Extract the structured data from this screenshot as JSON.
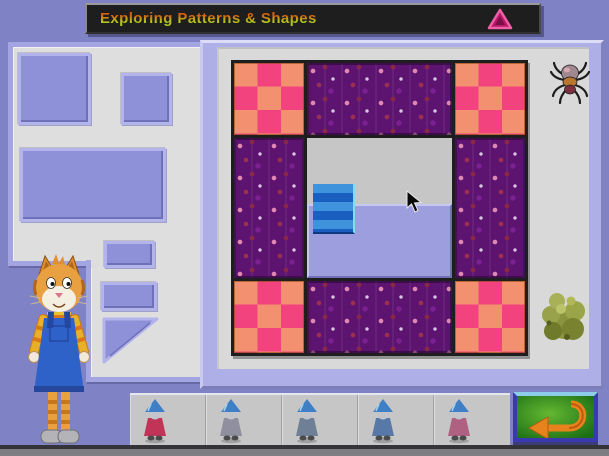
{
  "window": {
    "title": "Exploring Patterns & Shapes"
  },
  "titlebar": {
    "bg_color": "#1e1e1e",
    "title_color_top": "#d4620f",
    "title_color_bottom": "#b4c61a",
    "triangle_icon": "pink-triangle",
    "triangle_fill": "#b81868",
    "triangle_stroke": "#f060a8"
  },
  "palette": {
    "background": "#8082c6",
    "tray_bg": "#dededf",
    "tray_border": "#a3a5e2",
    "shape_fill": "#8f91d8",
    "mat_frame": "#aeafe6",
    "mat_bg": "#d9d9d9",
    "checker_salmon": "#f2906f",
    "checker_pink": "#f2437f",
    "floral_purple": "#5d1470",
    "workspace_gray": "#c6c6c6",
    "piece_blue_dark": "#1a5fc0",
    "piece_blue_light": "#3e93dc",
    "piece_lavender": "#9c9ede",
    "strip_bg": "#c6c6c6",
    "button_green": "#2f9a28",
    "button_border_blue": "#3a3aae",
    "button_arrow_orange": "#e8821c"
  },
  "tray": {
    "shapes": [
      {
        "name": "square-large",
        "type": "square"
      },
      {
        "name": "square-small",
        "type": "square"
      },
      {
        "name": "rectangle-large",
        "type": "rectangle"
      },
      {
        "name": "rectangle-small-top",
        "type": "rectangle"
      },
      {
        "name": "rectangle-small-bottom",
        "type": "rectangle"
      },
      {
        "name": "right-triangle",
        "type": "triangle"
      }
    ]
  },
  "quilt": {
    "rows": 3,
    "cols": 3,
    "cells": [
      [
        "checkered",
        "floral",
        "checkered"
      ],
      [
        "floral",
        "workspace",
        "floral"
      ],
      [
        "checkered",
        "floral",
        "checkered"
      ]
    ],
    "workspace_pieces": [
      {
        "name": "blue-striped-square"
      },
      {
        "name": "lavender-rectangle"
      }
    ]
  },
  "decorations": {
    "spider": "spider-icon",
    "bush": "bush-icon",
    "cat": "cat-guide-character"
  },
  "bottom_bar": {
    "mice": [
      {
        "name": "mouse-option-1",
        "dress_color": "#c23358"
      },
      {
        "name": "mouse-option-2",
        "dress_color": "#8f8fa0"
      },
      {
        "name": "mouse-option-3",
        "dress_color": "#6f7f96"
      },
      {
        "name": "mouse-option-4",
        "dress_color": "#5878a8"
      },
      {
        "name": "mouse-option-5",
        "dress_color": "#b06080"
      }
    ],
    "back_button_icon": "return-arrow"
  }
}
